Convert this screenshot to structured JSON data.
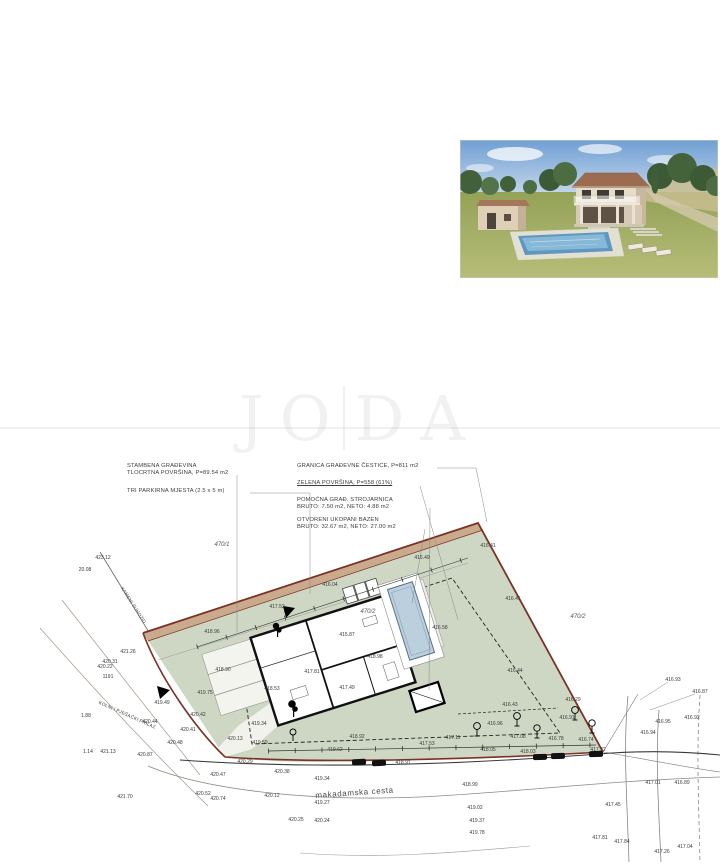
{
  "watermark": {
    "left": "JO",
    "right": "DA"
  },
  "photo": {
    "name": "house-3d-render"
  },
  "plan": {
    "labels": {
      "stambena_1": "STAMBENA GRAĐEVINA",
      "stambena_2": "TLOCRTNA POVRŠINA, P=89.54 m2",
      "parkirna": "TRI PARKIRNA MJESTA (2.5 x 5 m)",
      "granica": "GRANICA GRAĐEVNE ČESTICE, P=811 m2",
      "zelena": "ZELENA POVRŠINA, P=558 (61%)",
      "pomocna_1": "POMOĆNA GRAĐ. STROJARNICA",
      "pomocna_2": "BRUTO: 7.50 m2, NETO: 4.88 m2",
      "bazen_1": "OTVORENI UKOPANI BAZEN",
      "bazen_2": "BRUTO: 32.67 m2, NETO: 27.00 m2",
      "road": "makadamska cesta",
      "access": "KOLNI I PJEŠAČKI PRILAZ",
      "wall": "KAMENI SUHOZID"
    },
    "parcel_labels": [
      [
        222,
        545,
        "470/1"
      ],
      [
        578,
        617,
        "470/2"
      ],
      [
        368,
        612,
        "470/2"
      ]
    ],
    "spot_elevations": [
      [
        103,
        558,
        "423.12"
      ],
      [
        85,
        570,
        "20.08"
      ],
      [
        128,
        652,
        "421.26"
      ],
      [
        110,
        662,
        "420.31"
      ],
      [
        105,
        667,
        "420.22"
      ],
      [
        108,
        677,
        "1191"
      ],
      [
        86,
        716,
        "1.88"
      ],
      [
        88,
        752,
        "1.14"
      ],
      [
        108,
        752,
        "421.13"
      ],
      [
        145,
        755,
        "420.87"
      ],
      [
        125,
        797,
        "421.70"
      ],
      [
        150,
        722,
        "420.44"
      ],
      [
        198,
        715,
        "420.42"
      ],
      [
        188,
        730,
        "420.41"
      ],
      [
        175,
        743,
        "420.48"
      ],
      [
        162,
        703,
        "419.49"
      ],
      [
        212,
        632,
        "418.96"
      ],
      [
        223,
        670,
        "418.90"
      ],
      [
        205,
        693,
        "419.75"
      ],
      [
        272,
        689,
        "418.53"
      ],
      [
        312,
        672,
        "417.81"
      ],
      [
        347,
        688,
        "417.49"
      ],
      [
        375,
        657,
        "418.98"
      ],
      [
        347,
        635,
        "415.87"
      ],
      [
        277,
        607,
        "417.52"
      ],
      [
        330,
        585,
        "416.04"
      ],
      [
        422,
        558,
        "416.49"
      ],
      [
        488,
        546,
        "416.41"
      ],
      [
        513,
        599,
        "416.41"
      ],
      [
        440,
        628,
        "416.58"
      ],
      [
        515,
        671,
        "416.44"
      ],
      [
        510,
        705,
        "416.43"
      ],
      [
        495,
        724,
        "416.96"
      ],
      [
        573,
        700,
        "416.29"
      ],
      [
        567,
        718,
        "416.91"
      ],
      [
        518,
        737,
        "417.08"
      ],
      [
        556,
        739,
        "416.78"
      ],
      [
        586,
        740,
        "416.74"
      ],
      [
        453,
        738,
        "417.11"
      ],
      [
        488,
        750,
        "418.05"
      ],
      [
        528,
        752,
        "418.03"
      ],
      [
        598,
        750,
        "417.22"
      ],
      [
        259,
        724,
        "419.34"
      ],
      [
        235,
        739,
        "420.13"
      ],
      [
        260,
        743,
        "419.59"
      ],
      [
        357,
        737,
        "418.92"
      ],
      [
        335,
        750,
        "419.62"
      ],
      [
        427,
        744,
        "417.53"
      ],
      [
        403,
        763,
        "418.91"
      ],
      [
        245,
        762,
        "420.29"
      ],
      [
        218,
        775,
        "420.47"
      ],
      [
        282,
        772,
        "420.38"
      ],
      [
        322,
        779,
        "419.34"
      ],
      [
        272,
        796,
        "420.12"
      ],
      [
        322,
        803,
        "419.27"
      ],
      [
        203,
        794,
        "420.52"
      ],
      [
        218,
        799,
        "420.74"
      ],
      [
        296,
        820,
        "420.25"
      ],
      [
        322,
        821,
        "420.24"
      ],
      [
        470,
        785,
        "418.99"
      ],
      [
        475,
        808,
        "419.02"
      ],
      [
        477,
        821,
        "419.37"
      ],
      [
        477,
        833,
        "419.78"
      ],
      [
        673,
        680,
        "416.93"
      ],
      [
        700,
        692,
        "416.87"
      ],
      [
        663,
        722,
        "416.95"
      ],
      [
        692,
        718,
        "416.92"
      ],
      [
        648,
        733,
        "416.94"
      ],
      [
        653,
        783,
        "417.01"
      ],
      [
        682,
        783,
        "416.89"
      ],
      [
        613,
        805,
        "417.45"
      ],
      [
        600,
        838,
        "417.81"
      ],
      [
        622,
        842,
        "417.84"
      ],
      [
        662,
        852,
        "417.26"
      ],
      [
        685,
        847,
        "417.04"
      ]
    ],
    "colors": {
      "boundary": "#7b3224",
      "parcel_fill": "#cdd7c4",
      "wall_band": "#c8a283",
      "pool_water": "#bccfdd"
    }
  }
}
